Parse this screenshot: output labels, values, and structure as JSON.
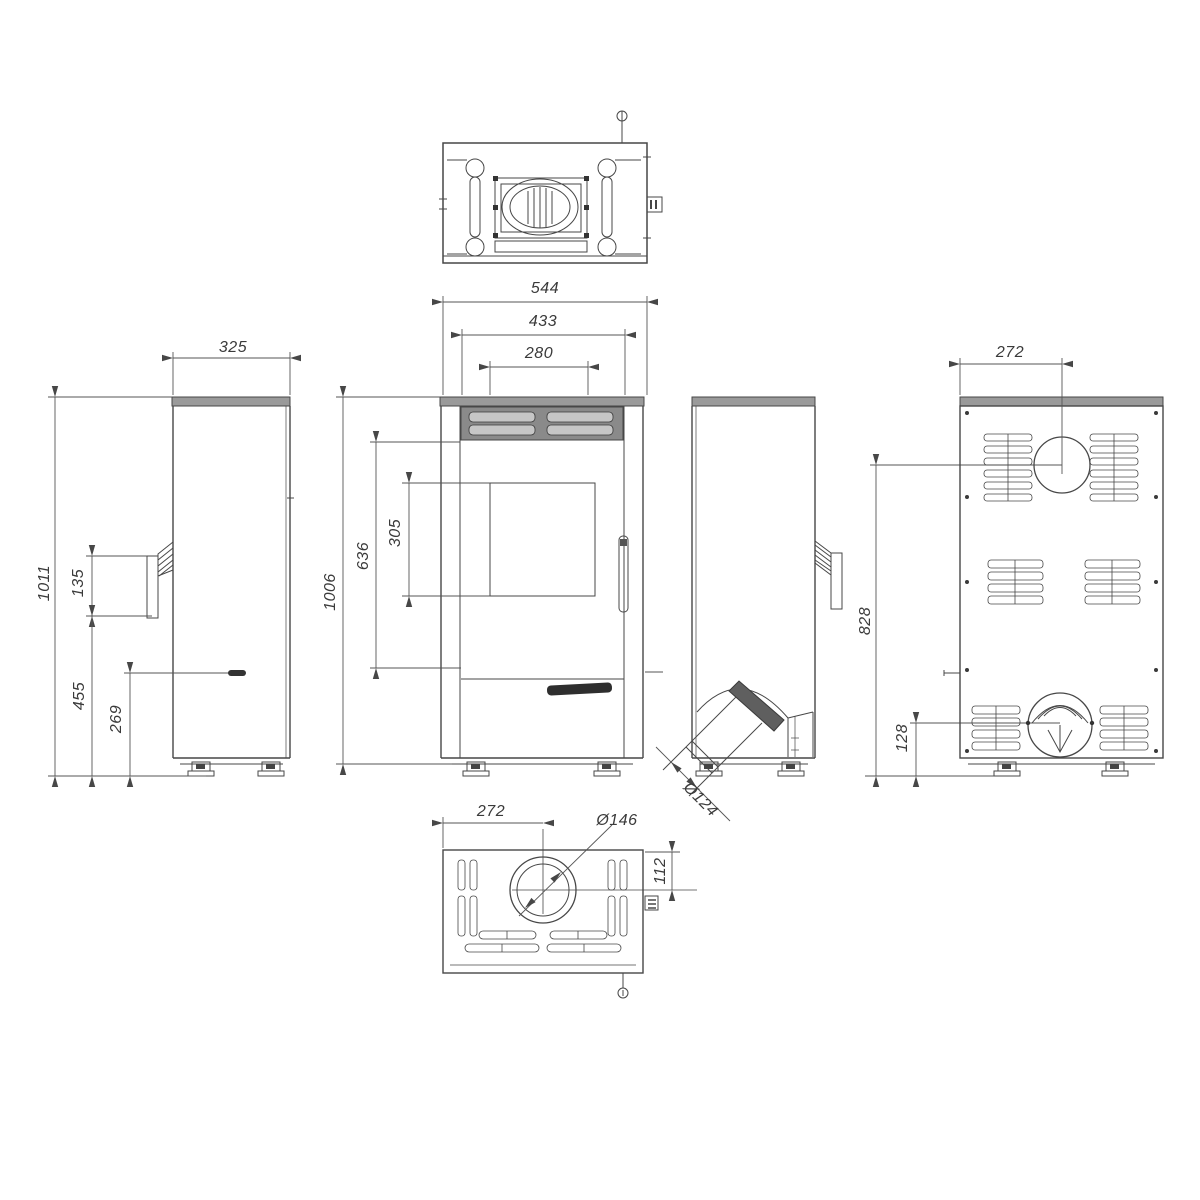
{
  "document": {
    "type": "technical-drawing",
    "subject": "pellet-stove-orthographic-views",
    "views": [
      "top-view",
      "left-side-view",
      "front-view",
      "right-side-view",
      "back-view",
      "bottom-view"
    ]
  },
  "colors": {
    "line": "#474747",
    "dim_line": "#565656",
    "top_plate_gray": "#9a9a9a",
    "grille_dark": "#8a8a8a",
    "slot_light": "#c6c6c6",
    "hatch_dark": "#5f5f5f",
    "label_dark": "#2e2e2e",
    "background": "#ffffff"
  },
  "dims": {
    "overall_width": "544",
    "body_width": "433",
    "glass_width": "280",
    "depth": "325",
    "total_height": "1011",
    "handle_height": "135",
    "handle_floor_height": "455",
    "side_inlet_height": "269",
    "body_height": "1006",
    "front_span": "636",
    "glass_height": "305",
    "rear_flue_height": "828",
    "rear_inlet_height": "128",
    "rear_flue_offset": "272",
    "bottom_offset": "272",
    "bottom_outlet_diameter": "Ø146",
    "bottom_outlet_inset": "112",
    "side_flue_diameter": "Ø124"
  }
}
